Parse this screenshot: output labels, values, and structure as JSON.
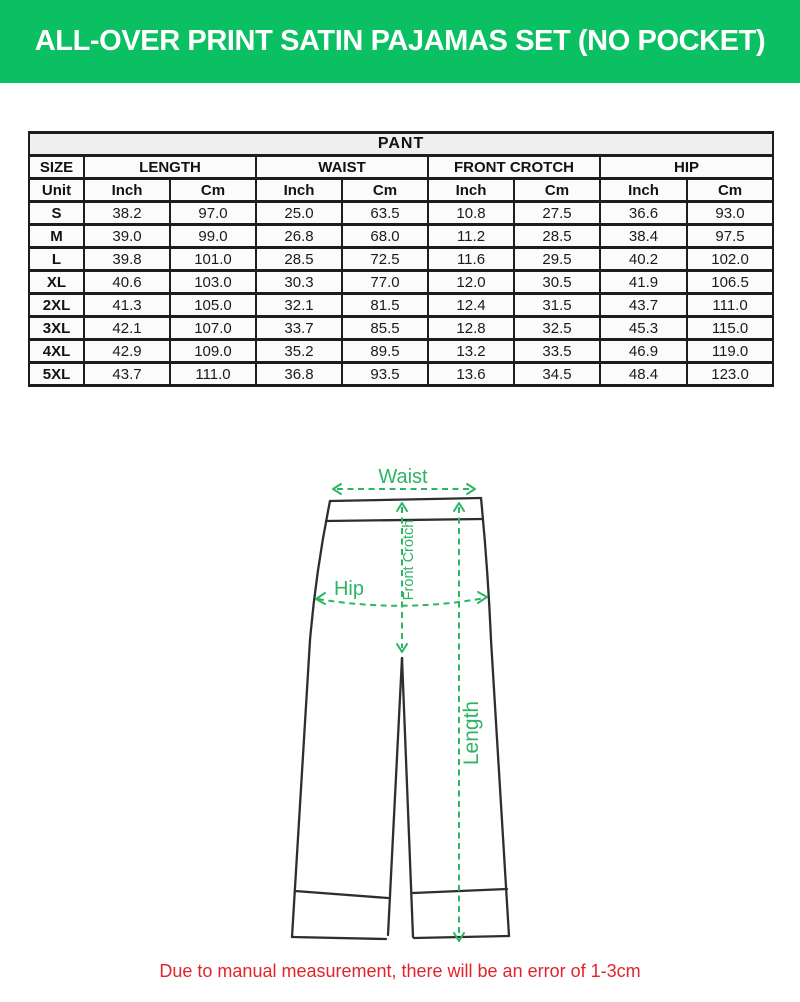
{
  "header": {
    "title": "ALL-OVER PRINT SATIN PAJAMAS SET (NO POCKET)"
  },
  "table": {
    "title": "PANT",
    "groups": [
      {
        "label": "SIZE"
      },
      {
        "label": "LENGTH"
      },
      {
        "label": "WAIST"
      },
      {
        "label": "FRONT CROTCH"
      },
      {
        "label": "HIP"
      }
    ],
    "unit_row": [
      "Unit",
      "Inch",
      "Cm",
      "Inch",
      "Cm",
      "Inch",
      "Cm",
      "Inch",
      "Cm"
    ],
    "rows": [
      {
        "size": "S",
        "values": [
          "38.2",
          "97.0",
          "25.0",
          "63.5",
          "10.8",
          "27.5",
          "36.6",
          "93.0"
        ]
      },
      {
        "size": "M",
        "values": [
          "39.0",
          "99.0",
          "26.8",
          "68.0",
          "11.2",
          "28.5",
          "38.4",
          "97.5"
        ]
      },
      {
        "size": "L",
        "values": [
          "39.8",
          "101.0",
          "28.5",
          "72.5",
          "11.6",
          "29.5",
          "40.2",
          "102.0"
        ]
      },
      {
        "size": "XL",
        "values": [
          "40.6",
          "103.0",
          "30.3",
          "77.0",
          "12.0",
          "30.5",
          "41.9",
          "106.5"
        ]
      },
      {
        "size": "2XL",
        "values": [
          "41.3",
          "105.0",
          "32.1",
          "81.5",
          "12.4",
          "31.5",
          "43.7",
          "111.0"
        ]
      },
      {
        "size": "3XL",
        "values": [
          "42.1",
          "107.0",
          "33.7",
          "85.5",
          "12.8",
          "32.5",
          "45.3",
          "115.0"
        ]
      },
      {
        "size": "4XL",
        "values": [
          "42.9",
          "109.0",
          "35.2",
          "89.5",
          "13.2",
          "33.5",
          "46.9",
          "119.0"
        ]
      },
      {
        "size": "5XL",
        "values": [
          "43.7",
          "111.0",
          "36.8",
          "93.5",
          "13.6",
          "34.5",
          "48.4",
          "123.0"
        ]
      }
    ]
  },
  "diagram": {
    "labels": {
      "waist": "Waist",
      "hip": "Hip",
      "front_crotch": "Front Crotch",
      "length": "Length"
    }
  },
  "footer": {
    "note": "Due to manual measurement, there will be an error of 1-3cm"
  },
  "colors": {
    "banner_green": "#0bbf63",
    "diagram_green": "#2db564",
    "note_red": "#e2232a",
    "table_border": "#1d1d1d"
  }
}
